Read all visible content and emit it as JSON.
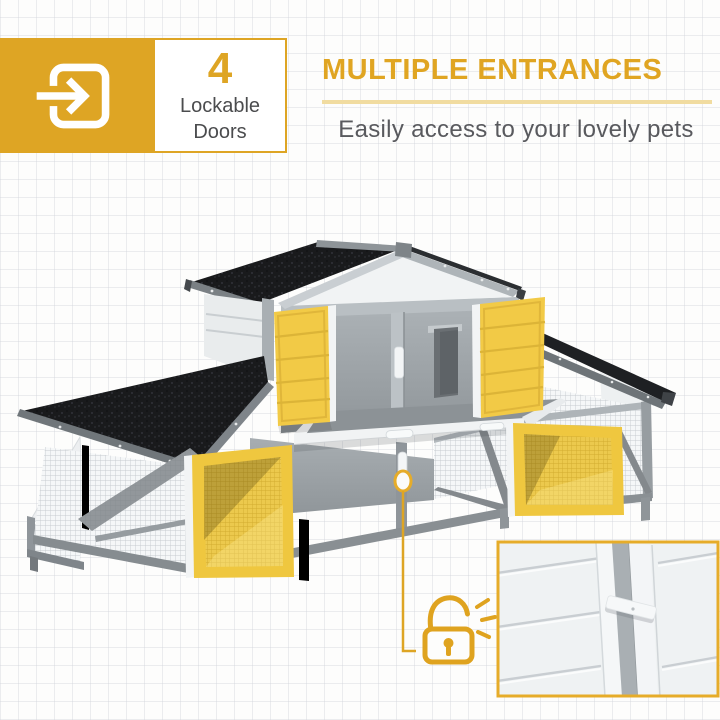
{
  "header": {
    "badge": {
      "count": "4",
      "line1": "Lockable",
      "line2": "Doors"
    },
    "title": "MULTIPLE ENTRANCES",
    "subtitle": "Easily access to your lovely pets"
  },
  "colors": {
    "gold": "#DEA524",
    "title_gold": "#E0A522",
    "divider": "#F1DCA0",
    "subtitle_gray": "#595A5E",
    "door_yellow": "#F2CA46",
    "door_yellow_frame": "#EFC73F",
    "roof_black": "#1A1B1D",
    "frame_gray": "#9CA2A6",
    "wall_white": "#EFF1F2",
    "callout_gold": "#DFA31F",
    "inset_border": "#E6AC29"
  },
  "icons": {
    "badge": "door-enter-icon",
    "callout": "unlocked-padlock-icon",
    "latch": "latch-highlight-ellipse"
  },
  "product": {
    "subject": "gray-white pet hutch with four open yellow doors",
    "inset": "close-up of sliding door latch"
  }
}
